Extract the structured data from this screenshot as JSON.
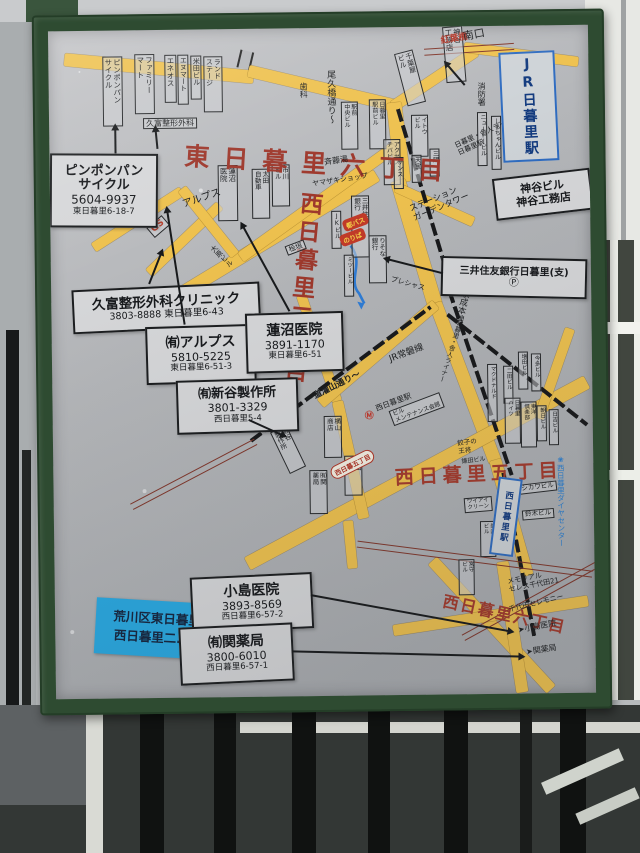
{
  "scene": {
    "colors": {
      "frame_green": "#2e4b31",
      "panel_gray": "#b5b7ba",
      "road_yellow": "#eec14e",
      "map_red": "#9e382c",
      "map_blue": "#2b7fd0",
      "notice_blue": "#29a9e2"
    }
  },
  "board": {
    "notice": {
      "line1": "荒川区東日暮里六丁目",
      "line2": "西日暮里二.五.六丁目"
    },
    "roads": [
      {
        "x": 16,
        "y": 22,
        "len": 190,
        "th": 13,
        "a": 6
      },
      {
        "x": 200,
        "y": 36,
        "len": 152,
        "th": 12,
        "a": 14
      },
      {
        "x": 344,
        "y": 74,
        "len": 100,
        "th": 11,
        "a": -33
      },
      {
        "x": 416,
        "y": 16,
        "len": 115,
        "th": 10,
        "a": 8
      },
      {
        "x": 345,
        "y": 68,
        "len": 80,
        "th": 15,
        "a": 84
      },
      {
        "x": 348,
        "y": 146,
        "len": 130,
        "th": 15,
        "a": 74
      },
      {
        "x": 384,
        "y": 270,
        "len": 170,
        "th": 13,
        "a": 70
      },
      {
        "x": 442,
        "y": 428,
        "len": 120,
        "th": 12,
        "a": 75
      },
      {
        "x": 83,
        "y": 285,
        "len": 283,
        "th": 13,
        "a": -30.5
      },
      {
        "x": 98,
        "y": 238,
        "len": 98,
        "th": 10,
        "a": -43
      },
      {
        "x": 43,
        "y": 212,
        "len": 105,
        "th": 10,
        "a": -32
      },
      {
        "x": 132,
        "y": 154,
        "len": 85,
        "th": 10,
        "a": 52
      },
      {
        "x": 190,
        "y": 223,
        "len": 190,
        "th": 11,
        "a": -35
      },
      {
        "x": 250,
        "y": 262,
        "len": 112,
        "th": 10,
        "a": 72
      },
      {
        "x": 346,
        "y": 155,
        "len": 85,
        "th": 10,
        "a": 25
      },
      {
        "x": 193,
        "y": 528,
        "len": 385,
        "th": 14,
        "a": -27.5
      },
      {
        "x": 285,
        "y": 368,
        "len": 120,
        "th": 11,
        "a": 78
      },
      {
        "x": 294,
        "y": 488,
        "len": 48,
        "th": 10,
        "a": 85
      },
      {
        "x": 268,
        "y": 370,
        "len": 152,
        "th": 11,
        "a": -40
      },
      {
        "x": 486,
        "y": 388,
        "len": 95,
        "th": 10,
        "a": -70
      },
      {
        "x": 378,
        "y": 528,
        "len": 175,
        "th": 12,
        "a": 48
      },
      {
        "x": 338,
        "y": 598,
        "len": 197,
        "th": 11,
        "a": -8
      },
      {
        "x": 448,
        "y": 530,
        "len": 132,
        "th": 12,
        "a": 82
      }
    ],
    "rails": [
      {
        "x": 349,
        "y": 80,
        "len": 190,
        "a": 74
      },
      {
        "x": 398,
        "y": 262,
        "len": 195,
        "a": 72
      },
      {
        "x": 450,
        "y": 445,
        "len": 168,
        "a": 80
      },
      {
        "x": 198,
        "y": 410,
        "len": 224,
        "a": -36
      },
      {
        "x": 396,
        "y": 286,
        "len": 178,
        "a": 39
      }
    ],
    "tram": [
      {
        "x": 78,
        "y": 473,
        "len": 140,
        "a": -27
      },
      {
        "x": 376,
        "y": 22,
        "len": 90,
        "a": -3
      },
      {
        "x": 303,
        "y": 513,
        "len": 237,
        "a": 8
      },
      {
        "x": 408,
        "y": 608,
        "len": 172,
        "a": -28
      }
    ],
    "buildings": [
      {
        "cols": [
          "ピンポンパン",
          "サイクル"
        ],
        "x": 54,
        "y": 26,
        "h": 66,
        "f": 7.5
      },
      {
        "cols": [
          "ファミリー",
          "マート"
        ],
        "x": 86,
        "y": 24,
        "h": 56,
        "f": 7.5
      },
      {
        "cols": [
          "エネオス"
        ],
        "x": 116,
        "y": 25,
        "h": 44,
        "f": 7.5
      },
      {
        "cols": [
          "エヌマート"
        ],
        "x": 129,
        "y": 25,
        "h": 46,
        "f": 7
      },
      {
        "cols": [
          "米田ビル"
        ],
        "x": 142,
        "y": 26,
        "h": 40,
        "f": 7
      },
      {
        "cols": [
          "ランド",
          "ステージ"
        ],
        "x": 155,
        "y": 27,
        "h": 52,
        "f": 7
      },
      {
        "cols": [
          "蓮沼",
          "医院"
        ],
        "x": 168,
        "y": 136,
        "h": 52,
        "f": 7.5
      },
      {
        "cols": [
          "太田",
          "自動車"
        ],
        "x": 202,
        "y": 140,
        "h": 46,
        "f": 6.5
      },
      {
        "cols": [
          "市川",
          "ビル"
        ],
        "x": 222,
        "y": 136,
        "h": 38,
        "f": 6.5
      },
      {
        "cols": [
          "千葉屋",
          "ビル"
        ],
        "x": 352,
        "y": 24,
        "h": 50,
        "f": 7,
        "r": -14
      },
      {
        "cols": [
          "神谷",
          "工務店"
        ],
        "x": 396,
        "y": 0,
        "h": 52,
        "f": 7.5,
        "r": -4
      },
      {
        "cols": [
          "駅前",
          "中央ビル"
        ],
        "x": 292,
        "y": 74,
        "h": 44,
        "f": 6
      },
      {
        "cols": [
          "日暮里",
          "駅前ビル"
        ],
        "x": 320,
        "y": 72,
        "h": 46,
        "f": 6
      },
      {
        "cols": [
          "アクセス",
          "チバビル"
        ],
        "x": 334,
        "y": 112,
        "h": 42,
        "f": 6
      },
      {
        "cols": [
          "イトウ",
          "ビル"
        ],
        "x": 362,
        "y": 88,
        "h": 38,
        "f": 6
      },
      {
        "cols": [
          "サンス"
        ],
        "x": 344,
        "y": 130,
        "h": 28,
        "f": 6
      },
      {
        "cols": [
          "天宝"
        ],
        "x": 362,
        "y": 128,
        "h": 24,
        "f": 6
      },
      {
        "cols": [
          "三陽"
        ],
        "x": 380,
        "y": 122,
        "h": 24,
        "f": 6
      },
      {
        "cols": [
          "ニュートービル"
        ],
        "x": 428,
        "y": 86,
        "h": 50,
        "f": 6
      },
      {
        "cols": [
          "しらちゃんビル"
        ],
        "x": 442,
        "y": 90,
        "h": 50,
        "f": 6
      },
      {
        "cols": [
          "三井住友",
          "銀行"
        ],
        "x": 301,
        "y": 168,
        "h": 58,
        "f": 6.5
      },
      {
        "cols": [
          "JKビル"
        ],
        "x": 281,
        "y": 183,
        "h": 34,
        "f": 6
      },
      {
        "cols": [
          "りそな",
          "銀行"
        ],
        "x": 318,
        "y": 208,
        "h": 44,
        "f": 6.5
      },
      {
        "cols": [
          "ミツービル"
        ],
        "x": 293,
        "y": 227,
        "h": 38,
        "f": 5.5
      },
      {
        "cols": [
          "新谷",
          "製作所"
        ],
        "x": 226,
        "y": 398,
        "h": 42,
        "f": 6.5,
        "r": -25
      },
      {
        "cols": [
          "横山",
          "商店"
        ],
        "x": 271,
        "y": 388,
        "h": 38,
        "f": 6.5
      },
      {
        "cols": [
          "秋山",
          "米店"
        ],
        "x": 291,
        "y": 428,
        "h": 36,
        "f": 6.5
      },
      {
        "cols": [
          "㈲関",
          "薬局"
        ],
        "x": 256,
        "y": 442,
        "h": 40,
        "f": 6.5
      },
      {
        "cols": [
          "マクドナルド"
        ],
        "x": 435,
        "y": 338,
        "h": 54,
        "f": 5.5
      },
      {
        "cols": [
          "二田ビル"
        ],
        "x": 451,
        "y": 340,
        "h": 34,
        "f": 5.5
      },
      {
        "cols": [
          "増田ビル"
        ],
        "x": 466,
        "y": 326,
        "h": 34,
        "f": 5.5
      },
      {
        "cols": [
          "今多ビル"
        ],
        "x": 479,
        "y": 328,
        "h": 34,
        "f": 5.5
      },
      {
        "cols": [
          "日暮里",
          "ハイツ"
        ],
        "x": 452,
        "y": 372,
        "h": 42,
        "f": 5.5
      },
      {
        "cols": [
          "東洋",
          "倶楽部"
        ],
        "x": 468,
        "y": 376,
        "h": 42,
        "f": 5.5
      },
      {
        "cols": [
          "朝日ビル"
        ],
        "x": 484,
        "y": 380,
        "h": 32,
        "f": 5.5
      },
      {
        "cols": [
          "日吉ビル"
        ],
        "x": 496,
        "y": 384,
        "h": 32,
        "f": 5.5
      },
      {
        "cols": [
          "美内",
          "ビル"
        ],
        "x": 426,
        "y": 495,
        "h": 32,
        "f": 5.5
      },
      {
        "cols": [
          "宮守",
          "ビル"
        ],
        "x": 404,
        "y": 533,
        "h": 32,
        "f": 5.5
      }
    ],
    "labels": [
      {
        "t": "東日暮里六丁目",
        "x": 136,
        "y": 112,
        "f": 25,
        "ls": 14,
        "c": "#9e382c",
        "b": 1,
        "r": 4,
        "n": "area-label-higashi-nippori-6"
      },
      {
        "t": "西日暮里二丁目",
        "x": 246,
        "y": 162,
        "f": 23,
        "ls": 5,
        "c": "#9e382c",
        "b": 1,
        "r": 6,
        "v": 1,
        "n": "area-label-nishi-nippori-2"
      },
      {
        "t": "西日暮里五丁目",
        "x": 341,
        "y": 440,
        "f": 19,
        "ls": 5,
        "c": "#a33a2c",
        "b": 1,
        "r": -2,
        "n": "area-label-nishi-nippori-5"
      },
      {
        "t": "西日暮里六丁目",
        "x": 390,
        "y": 566,
        "f": 16,
        "ls": 2,
        "c": "#a33a2c",
        "b": 1,
        "r": 13,
        "n": "area-label-nishi-nippori-6"
      },
      {
        "t": "紅葉橋",
        "x": 392,
        "y": 10,
        "f": 9,
        "c": "#b03527",
        "b": 1,
        "r": -9,
        "n": "bridge-label"
      },
      {
        "t": "GS",
        "x": 96,
        "y": 198,
        "f": 9,
        "c": "#b8402f",
        "b": 1,
        "r": -40,
        "brd": 1,
        "n": "gas-station-label"
      },
      {
        "t": "南口",
        "x": 414,
        "y": 5,
        "f": 11,
        "r": -10
      },
      {
        "t": "消防署",
        "x": 428,
        "y": 56,
        "f": 8,
        "v": 1
      },
      {
        "t": "歯科",
        "x": 250,
        "y": 54,
        "f": 8,
        "v": 1
      },
      {
        "t": "斉藤湯",
        "x": 274,
        "y": 130,
        "f": 8,
        "r": -8
      },
      {
        "t": "ヤマザキショップ",
        "x": 262,
        "y": 152,
        "f": 7,
        "r": -8
      },
      {
        "t": "アルプス",
        "x": 131,
        "y": 170,
        "f": 10,
        "r": -18
      },
      {
        "t": "大原ビル",
        "x": 158,
        "y": 220,
        "f": 7,
        "v": 1,
        "r": -45
      },
      {
        "t": "久富整形外科",
        "x": 94,
        "y": 88,
        "f": 8,
        "brd": 1
      },
      {
        "t": "桧垣",
        "x": 234,
        "y": 218,
        "f": 7,
        "brd": 1,
        "r": -20
      },
      {
        "t": "尾久橋通り〜",
        "x": 276,
        "y": 42,
        "f": 9,
        "v": 1
      },
      {
        "lines": [
          "日暮里・舎人ライナー",
          "日暮里駅"
        ],
        "x": 404,
        "y": 116,
        "f": 7,
        "r": -24
      },
      {
        "lines": [
          "ステーション",
          "ガーデンタワー"
        ],
        "x": 358,
        "y": 178,
        "f": 8.5,
        "r": -22
      },
      {
        "t": "JR常磐線",
        "x": 336,
        "y": 328,
        "f": 9,
        "r": -20
      },
      {
        "t": "京成本線",
        "x": 410,
        "y": 262,
        "f": 8.5,
        "v": 1,
        "r": 14
      },
      {
        "t": "〜道灌山通り〜",
        "x": 252,
        "y": 368,
        "f": 8.5,
        "b": 1,
        "r": -26
      },
      {
        "t": "日暮里・舎人ライナー",
        "x": 404,
        "y": 292,
        "f": 6.5,
        "v": 1,
        "r": 18
      },
      {
        "t": "プレシャス",
        "x": 341,
        "y": 248,
        "f": 7,
        "r": 16
      },
      {
        "t": "Ⓜ",
        "x": 312,
        "y": 384,
        "f": 9,
        "c": "#c23427",
        "b": 1,
        "n": "metro-icon"
      },
      {
        "t": "西日暮里駅",
        "x": 322,
        "y": 378,
        "f": 7.5,
        "r": -20,
        "n": "metro-station-label"
      },
      {
        "lines": [
          "ビル",
          "メンテナンス会館"
        ],
        "x": 336,
        "y": 384,
        "f": 6,
        "brd": 1,
        "r": -20
      },
      {
        "lines": [
          "餃子の",
          "王将"
        ],
        "x": 404,
        "y": 414,
        "f": 6.5,
        "r": -6
      },
      {
        "t": "鎌田ビル",
        "x": 408,
        "y": 432,
        "f": 6,
        "r": -6
      },
      {
        "t": "ニシカワビル",
        "x": 458,
        "y": 460,
        "f": 6.5,
        "brd": 1,
        "r": -6
      },
      {
        "t": "鈴木ビル",
        "x": 468,
        "y": 485,
        "f": 6.5,
        "brd": 1,
        "r": -4
      },
      {
        "lines": [
          "ワイアイ",
          "クリーン"
        ],
        "x": 410,
        "y": 472,
        "f": 5.5,
        "brd": 1,
        "r": -4
      },
      {
        "lines": [
          "メモリアル",
          "セレス千代田21"
        ],
        "x": 452,
        "y": 552,
        "f": 7,
        "r": -10
      },
      {
        "t": "千代田セレモニー",
        "x": 453,
        "y": 580,
        "f": 7,
        "r": -13
      },
      {
        "t": "➤小島医院",
        "x": 462,
        "y": 600,
        "f": 8,
        "r": -10
      },
      {
        "t": "➤関薬局",
        "x": 470,
        "y": 622,
        "f": 8,
        "r": -8
      },
      {
        "t": "❀西日暮里ダイヤセンター",
        "x": 502,
        "y": 430,
        "f": 7.5,
        "v": 1,
        "c": "#2b7fd0",
        "n": "blue-side-label"
      }
    ],
    "pills": [
      {
        "t": "都バス",
        "x": 293,
        "y": 193,
        "r": -20,
        "n": "bus-stop-tag"
      },
      {
        "t": "のりば",
        "x": 290,
        "y": 208,
        "r": -20,
        "n": "bus-stop-tag"
      },
      {
        "t": "西日暮五丁目",
        "x": 278,
        "y": 440,
        "r": -26,
        "o": 1,
        "n": "road-area-oval"
      }
    ],
    "info_boxes": [
      {
        "x": 0,
        "y": 123,
        "w": 104,
        "h": 70,
        "r": 1,
        "lines": [
          {
            "t": "ピンポンパン",
            "f": 13,
            "b": 1
          },
          {
            "t": "サイクル",
            "f": 13,
            "b": 1
          },
          {
            "t": "5604-9937",
            "f": 12
          },
          {
            "t": "東日暮里6-18-7",
            "f": 8.5
          }
        ]
      },
      {
        "x": 21,
        "y": 256,
        "w": 184,
        "h": 40,
        "r": -2,
        "lines": [
          {
            "t": "久富整形外科クリニック",
            "f": 13.5,
            "b": 1
          },
          {
            "t": "3803-8888 東日暮里6-43",
            "f": 9.5
          }
        ]
      },
      {
        "x": 94,
        "y": 296,
        "w": 106,
        "h": 54,
        "r": -1,
        "lines": [
          {
            "t": "㈲アルプス",
            "f": 14,
            "b": 1
          },
          {
            "t": "5810-5225",
            "f": 11
          },
          {
            "t": "東日暮里6-51-3",
            "f": 8.5
          }
        ]
      },
      {
        "x": 194,
        "y": 284,
        "w": 94,
        "h": 56,
        "r": -1,
        "lines": [
          {
            "t": "蓮沼医院",
            "f": 14,
            "b": 1
          },
          {
            "t": "3891-1170",
            "f": 11
          },
          {
            "t": "東日暮里6-51",
            "f": 8.5
          }
        ]
      },
      {
        "x": 124,
        "y": 350,
        "w": 118,
        "h": 50,
        "r": -1,
        "lines": [
          {
            "t": "㈲新谷製作所",
            "f": 13,
            "b": 1
          },
          {
            "t": "3801-3329",
            "f": 11
          },
          {
            "t": "西日暮里5-4",
            "f": 8.5
          }
        ]
      },
      {
        "x": 390,
        "y": 232,
        "w": 142,
        "h": 36,
        "r": 2,
        "lines": [
          {
            "t": "三井住友銀行日暮里(支)",
            "f": 10,
            "b": 1
          },
          {
            "t": "Ⓟ",
            "f": 10
          }
        ]
      },
      {
        "x": 444,
        "y": 148,
        "w": 94,
        "h": 38,
        "r": -6,
        "lines": [
          {
            "t": "神谷ビル",
            "f": 11,
            "b": 1
          },
          {
            "t": "神谷工務店",
            "f": 11,
            "b": 1
          }
        ]
      },
      {
        "x": 136,
        "y": 546,
        "w": 118,
        "h": 52,
        "r": -2,
        "lines": [
          {
            "t": "小島医院",
            "f": 14,
            "b": 1
          },
          {
            "t": "3893-8569",
            "f": 11
          },
          {
            "t": "西日暮里6-57-2",
            "f": 8.5
          }
        ]
      },
      {
        "x": 124,
        "y": 596,
        "w": 110,
        "h": 54,
        "r": -2,
        "lines": [
          {
            "t": "㈲関薬局",
            "f": 14,
            "b": 1
          },
          {
            "t": "3800-6010",
            "f": 11
          },
          {
            "t": "西日暮里6-57-1",
            "f": 8.5
          }
        ]
      }
    ],
    "stations": [
      {
        "t": "JR日暮里駅",
        "x": 452,
        "y": 26,
        "w": 52,
        "h": 106,
        "f": 14,
        "r": -2,
        "n": "station-box-nippori"
      },
      {
        "t": "西日暮里駅",
        "x": 440,
        "y": 452,
        "w": 20,
        "h": 74,
        "f": 8.5,
        "r": 8,
        "n": "station-box-nishi-nippori"
      }
    ],
    "arrows": [
      {
        "x": 66,
        "y": 122,
        "len": 28,
        "a": -90
      },
      {
        "x": 108,
        "y": 118,
        "len": 22,
        "a": -95
      },
      {
        "x": 98,
        "y": 253,
        "len": 36,
        "a": -68
      },
      {
        "x": 238,
        "y": 282,
        "len": 100,
        "a": -118
      },
      {
        "x": 133,
        "y": 294,
        "len": 118,
        "a": -98
      },
      {
        "x": 196,
        "y": 390,
        "len": 40,
        "a": 25
      },
      {
        "x": 256,
        "y": 566,
        "len": 205,
        "a": 11
      },
      {
        "x": 236,
        "y": 622,
        "len": 232,
        "a": 2
      },
      {
        "x": 416,
        "y": 58,
        "len": 30,
        "a": -130
      },
      {
        "x": 392,
        "y": 246,
        "len": 60,
        "a": -165
      }
    ]
  }
}
